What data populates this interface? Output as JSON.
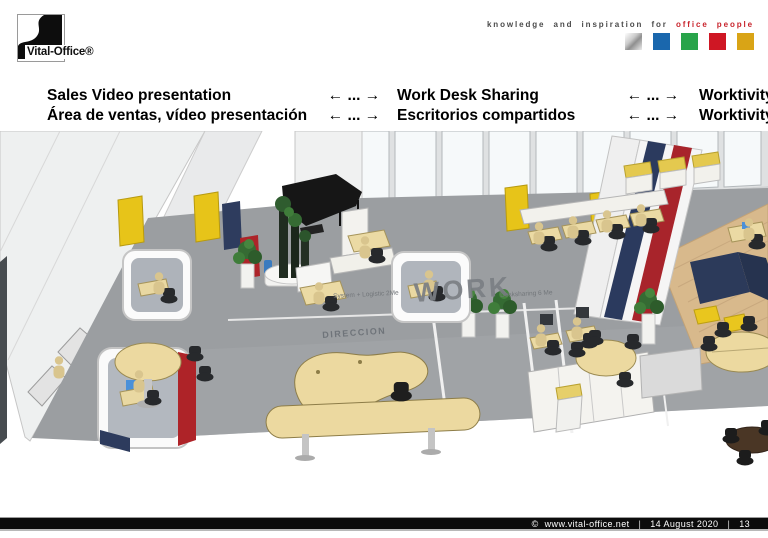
{
  "brand": {
    "logo_text": "Vital-Office®",
    "tagline_prefix": "knowledge and inspiration for",
    "tagline_highlight": "office people",
    "tagline_highlight_color": "#c8242c",
    "palette_squares": [
      "silver-gradient",
      "#1a67ad",
      "#28a44a",
      "#cf1724",
      "#d9a416"
    ]
  },
  "header": {
    "rows": [
      {
        "left": "Sales Video presentation",
        "arrow_left": "← ... →",
        "center": "Work Desk Sharing",
        "arrow_right": "← ... →",
        "right": "Worktivity"
      },
      {
        "left": "Área de ventas, vídeo presentación",
        "arrow_left": "← ... →",
        "center": "Escritorios compartidos",
        "arrow_right": "← ... →",
        "right": "Worktivity"
      }
    ]
  },
  "scene": {
    "floor_labels": {
      "system_logistic": "System + Logistic 2Me",
      "work": "WORK",
      "desksharing": "Desksharing 6 Me",
      "direccion": "DIRECCION"
    }
  },
  "footer": {
    "copyright": "©",
    "website": "www.vital-office.net",
    "separator": "|",
    "date": "14 August 2020",
    "page_number": "13"
  }
}
